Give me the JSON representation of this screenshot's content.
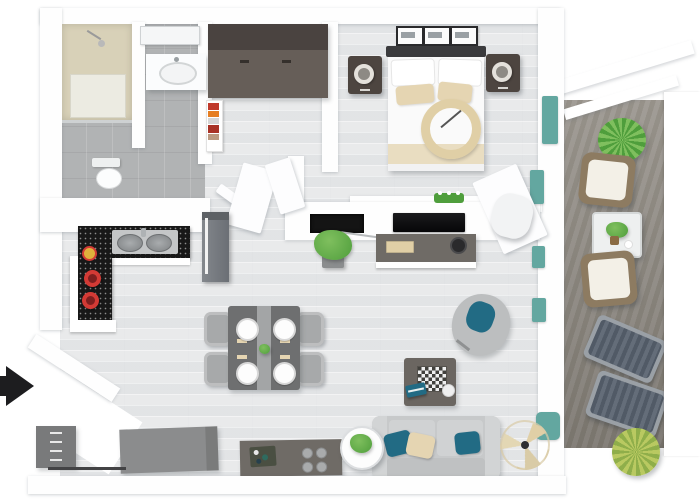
{
  "scene": {
    "type": "3d-apartment-floor-plan-top-view",
    "description": "Photorealistic top-down 3D render of a one-bedroom apartment with balcony",
    "entrance_marker": "black right-pointing arrow at left edge"
  },
  "colors": {
    "wall": "#fefefe",
    "wood": "#e7e8e9",
    "tile": "#b1b3b4",
    "deck": "#8e897f",
    "granite": "#181818",
    "counter-gray": "#6f6b66",
    "table-gray": "#6e6f70",
    "chair-gray": "#a7a9aa",
    "sofa": "#c7c9ca",
    "teal-pillow": "#226b84",
    "window-teal": "#63a7a0",
    "pillow-beige": "#e5d5b2",
    "beige": "#e0cfa6",
    "shower-beige": "#d8d1b8",
    "wardrobe": "#665e58",
    "wardrobe-top": "#4a4340",
    "nightstand": "#4d4540",
    "headboard": "#3b3b3d",
    "bed-white": "#fafafa",
    "plant-green": "#4f9e3c",
    "plant-light": "#7fbf5e",
    "plant-yellow": "#b9c961",
    "plant-yellow-dark": "#8fae4a",
    "pot-red": "#d33a35",
    "wicker": "#8d7b61",
    "cushion-white": "#f3f0e7",
    "lounger-slat": "#515a66",
    "arrow": "#1d1d1f"
  },
  "rooms": {
    "bathroom": {
      "label": "Bathroom",
      "items": [
        "walk-in shower",
        "vanity sink",
        "mirror",
        "toilet"
      ]
    },
    "closet": {
      "label": "Closet hall",
      "items": [
        "dark wardrobe",
        "bookshelf with red and orange books"
      ]
    },
    "bedroom": {
      "label": "Bedroom",
      "items": [
        "double bed with beige pillows and ring throw",
        "2 nightstands",
        "2 lamps",
        "3 framed pictures"
      ]
    },
    "kitchen": {
      "label": "Kitchen",
      "items": [
        "L-shaped black granite counter",
        "double sink",
        "2 red pots",
        "fruit bowl",
        "tall gray cabinet",
        "island with cooktop"
      ]
    },
    "dining": {
      "label": "Dining area",
      "items": [
        "rectangular table with runner",
        "4 gray chairs",
        "4 white plates",
        "green centerpiece"
      ]
    },
    "living": {
      "label": "Living room",
      "items": [
        "media wall with fireplace",
        "wall TV",
        "desk with keyboard",
        "white desk chair",
        "potted plant",
        "chess coffee table",
        "gray swivel chair with teal cushion",
        "gray sofa with teal and beige pillows",
        "round side table with plant",
        "decorative fan"
      ]
    },
    "entry": {
      "label": "Entrance",
      "items": [
        "entry arrow",
        "gray drawer cabinet",
        "gray console cabinet",
        "angled entry wall"
      ]
    },
    "balcony": {
      "label": "Balcony",
      "items": [
        "2 wicker armchairs with white cushions",
        "glass coffee table with plant",
        "2 sun loungers",
        "2 spiky plants",
        "wood plank deck"
      ]
    }
  }
}
